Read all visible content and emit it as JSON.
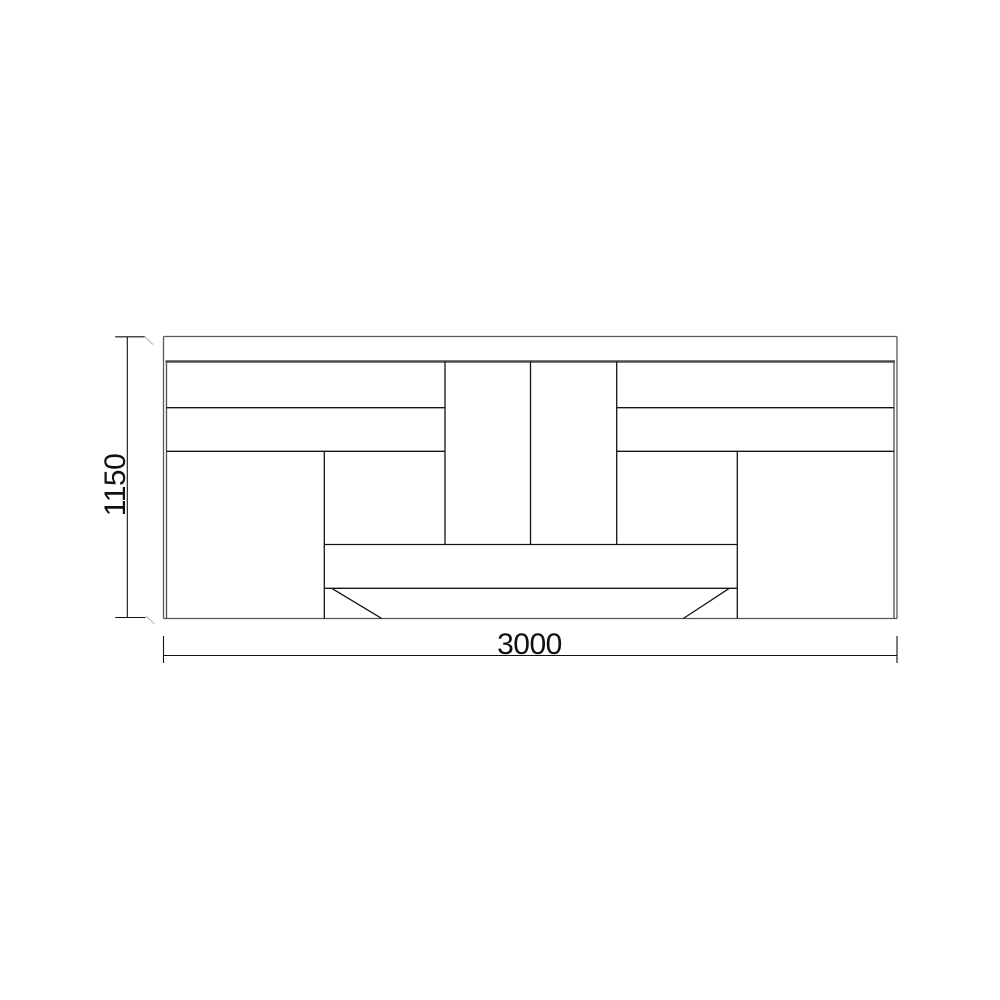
{
  "page": {
    "background": "#ffffff"
  },
  "drawing": {
    "type": "furniture-elevation",
    "description": "cabinet front elevation with dimensions",
    "palette": {
      "shell": "#575757",
      "inner": "#4d4d4d",
      "heavy": "#4d4d4d",
      "detail": "#141414",
      "dim": "#111111",
      "faint": "#b3b3b3",
      "text": "#111111"
    },
    "dimensions": {
      "width": {
        "label": "3000"
      },
      "height": {
        "label": "1150"
      }
    },
    "segments": [
      {
        "name": "shell-top",
        "kind": "shell",
        "x1": 163.5,
        "y1": 336.5,
        "x2": 897,
        "y2": 336.5
      },
      {
        "name": "shell-bottom",
        "kind": "shell",
        "x1": 163.5,
        "y1": 618.5,
        "x2": 897,
        "y2": 618.5
      },
      {
        "name": "shell-left",
        "kind": "shell",
        "x1": 163.5,
        "y1": 336.5,
        "x2": 163.5,
        "y2": 618.5
      },
      {
        "name": "shell-right",
        "kind": "shell",
        "x1": 897,
        "y1": 336.5,
        "x2": 897,
        "y2": 618.5
      },
      {
        "name": "body-left-edge",
        "kind": "inner",
        "x1": 166.5,
        "y1": 361.5,
        "x2": 166.5,
        "y2": 618.5
      },
      {
        "name": "body-right-edge",
        "kind": "inner",
        "x1": 894,
        "y1": 361.5,
        "x2": 894,
        "y2": 618.5
      },
      {
        "name": "worktop-underside",
        "kind": "heavy",
        "x1": 165.5,
        "y1": 361.5,
        "x2": 895,
        "y2": 361.5
      },
      {
        "name": "left-drawer-divider-upper",
        "kind": "detail",
        "x1": 166.5,
        "y1": 407.7,
        "x2": 445,
        "y2": 407.7
      },
      {
        "name": "left-drawer-divider-lower",
        "kind": "detail",
        "x1": 166.5,
        "y1": 451.3,
        "x2": 445,
        "y2": 451.3
      },
      {
        "name": "right-drawer-divider-upper",
        "kind": "detail",
        "x1": 616.7,
        "y1": 407.7,
        "x2": 894,
        "y2": 407.7
      },
      {
        "name": "right-drawer-divider-lower",
        "kind": "detail",
        "x1": 616.7,
        "y1": 451.3,
        "x2": 894,
        "y2": 451.3
      },
      {
        "name": "center-door-left-edge",
        "kind": "detail",
        "x1": 445,
        "y1": 361.5,
        "x2": 445,
        "y2": 544.5
      },
      {
        "name": "center-door-divider",
        "kind": "detail",
        "x1": 530.5,
        "y1": 361.5,
        "x2": 530.5,
        "y2": 544.5
      },
      {
        "name": "center-door-right-edge",
        "kind": "detail",
        "x1": 616.7,
        "y1": 361.5,
        "x2": 616.7,
        "y2": 544.5
      },
      {
        "name": "left-pedestal-inner-edge",
        "kind": "detail",
        "x1": 324.3,
        "y1": 451.3,
        "x2": 324.3,
        "y2": 618.5
      },
      {
        "name": "right-pedestal-inner-edge",
        "kind": "detail",
        "x1": 737.3,
        "y1": 451.3,
        "x2": 737.3,
        "y2": 618.5
      },
      {
        "name": "center-shelf-line",
        "kind": "detail",
        "x1": 324.3,
        "y1": 544.5,
        "x2": 737.3,
        "y2": 544.5
      },
      {
        "name": "plinth-top-line",
        "kind": "detail",
        "x1": 324.3,
        "y1": 588.3,
        "x2": 737.3,
        "y2": 588.3
      },
      {
        "name": "plinth-left-bevel",
        "kind": "detail",
        "x1": 331.7,
        "y1": 588.3,
        "x2": 381.7,
        "y2": 618.5
      },
      {
        "name": "plinth-right-bevel",
        "kind": "detail",
        "x1": 729.3,
        "y1": 588.3,
        "x2": 683.3,
        "y2": 618.5
      },
      {
        "name": "height-dim-line",
        "kind": "dim",
        "x1": 127.3,
        "y1": 336.8,
        "x2": 127.3,
        "y2": 617.5
      },
      {
        "name": "height-dim-tick-top",
        "kind": "dim",
        "x1": 115.3,
        "y1": 336.8,
        "x2": 145.5,
        "y2": 336.8
      },
      {
        "name": "height-dim-tick-bottom",
        "kind": "dim",
        "x1": 115.3,
        "y1": 617.5,
        "x2": 145.5,
        "y2": 617.5
      },
      {
        "name": "width-dim-line",
        "kind": "dim",
        "x1": 163.5,
        "y1": 655.5,
        "x2": 897,
        "y2": 655.5
      },
      {
        "name": "width-dim-ext-left",
        "kind": "dim",
        "x1": 163.5,
        "y1": 636,
        "x2": 163.5,
        "y2": 663
      },
      {
        "name": "width-dim-ext-right",
        "kind": "dim",
        "x1": 897,
        "y1": 636,
        "x2": 897,
        "y2": 663
      },
      {
        "name": "height-dim-oblique-top",
        "kind": "faint",
        "x1": 144.5,
        "y1": 336.5,
        "x2": 153,
        "y2": 344.5
      },
      {
        "name": "height-dim-oblique-bottom",
        "kind": "faint",
        "x1": 146,
        "y1": 616,
        "x2": 154.5,
        "y2": 624
      }
    ]
  }
}
